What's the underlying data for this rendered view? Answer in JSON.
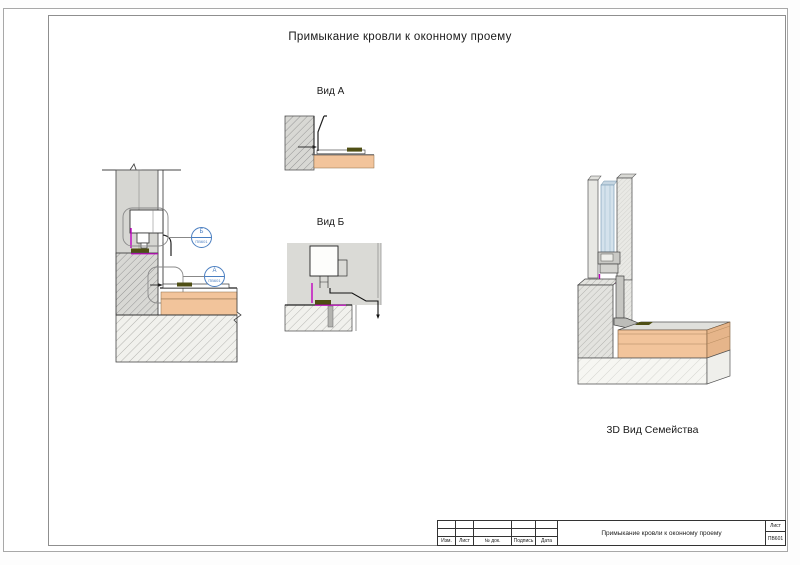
{
  "sheet": {
    "title": "Примыкание кровли к оконному проему",
    "number": "ПВ601"
  },
  "views": {
    "view_a": {
      "label": "Вид А"
    },
    "view_b": {
      "label": "Вид Б"
    },
    "view_3d": {
      "label": "3D Вид Семейства"
    }
  },
  "callouts": {
    "b": {
      "letter": "Б",
      "sheet_ref": "ПВ601"
    },
    "a": {
      "letter": "А",
      "sheet_ref": "ПВ601"
    }
  },
  "title_block": {
    "columns": [
      "Изм.",
      "Лист",
      "№ док.",
      "Подпись",
      "Дата"
    ],
    "title": "Примыкание кровли к оконному проему",
    "sheet_label": "Лист",
    "sheet_number": "ПВ601"
  },
  "colors": {
    "callout_blue": "#4a7ec0",
    "seal_magenta": "#c000c0",
    "roof_orange": "#f2c49b",
    "olive_dark": "#4f4f14",
    "wall_gray": "#d6d6d2",
    "glazing_blue": "#d4e2ec"
  }
}
